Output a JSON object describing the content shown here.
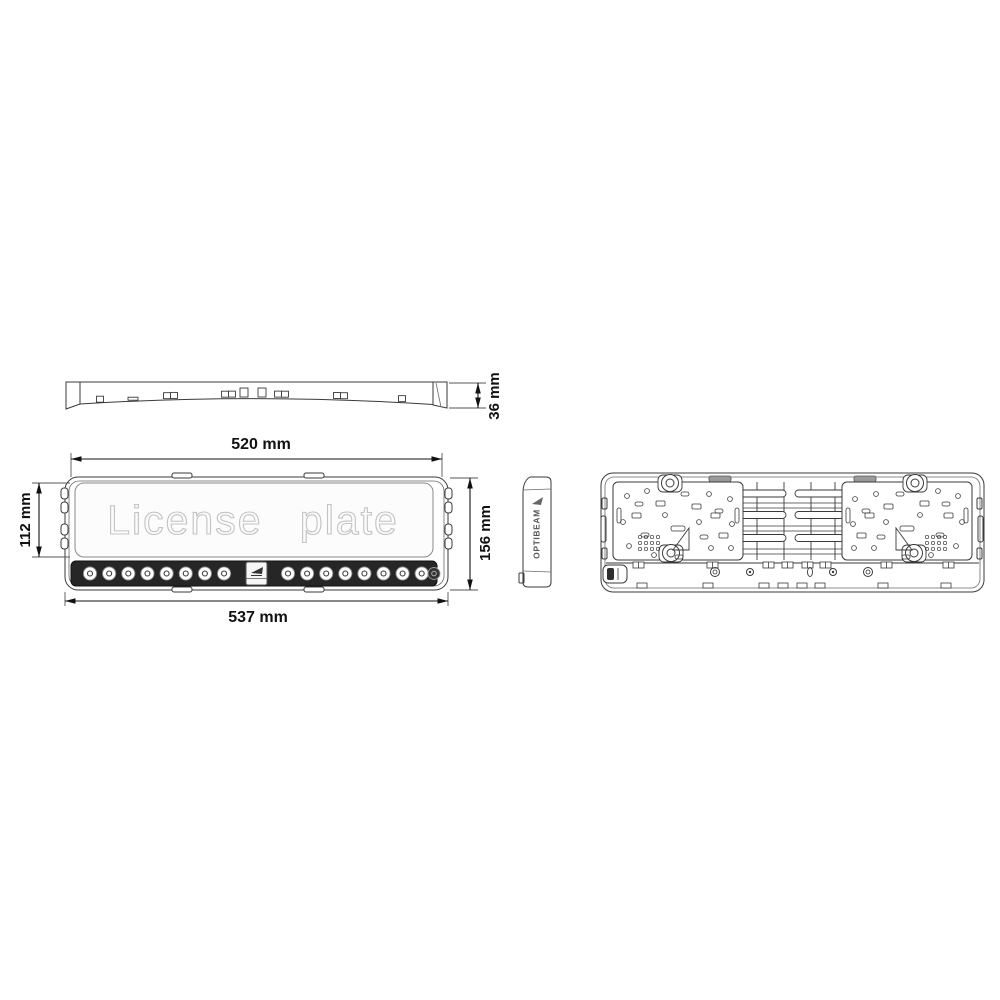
{
  "page": {
    "background_color": "#ffffff"
  },
  "drawing": {
    "ink_color": "#3a3a3a",
    "dim_text_color": "#111111",
    "dimensions": {
      "profile_height": "36 mm",
      "plate_width": "520 mm",
      "plate_height": "112 mm",
      "total_height": "156 mm",
      "total_width": "537 mm"
    },
    "views": {
      "front": {
        "plate_text": "License plate",
        "led_count_left": 8,
        "led_count_right": 8,
        "strip_color": "#262626",
        "led_lens_color": "#ffffff"
      },
      "side": {
        "brand_text": "OPTIBEAM"
      },
      "top_profile": {},
      "back": {}
    }
  }
}
